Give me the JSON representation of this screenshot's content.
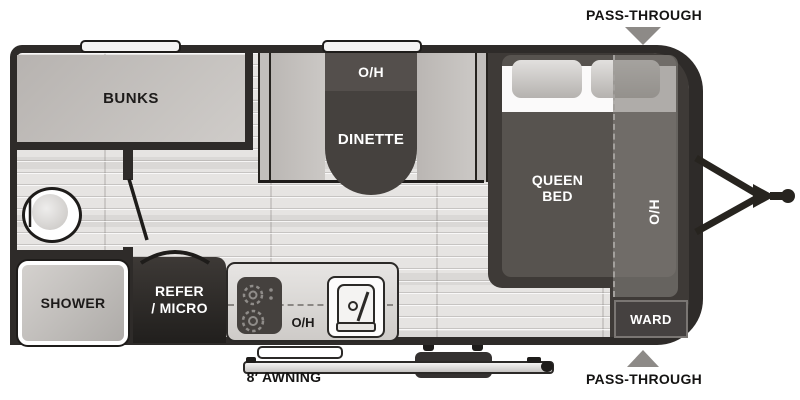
{
  "floorplan": {
    "exterior": {
      "pass_through_top": "PASS-THROUGH",
      "pass_through_bottom": "PASS-THROUGH",
      "awning": "8′ AWNING"
    },
    "rooms": {
      "bunks": "BUNKS",
      "dinette": {
        "overhead": "O/H",
        "name": "DINETTE"
      },
      "bedroom": {
        "bed_line1": "QUEEN",
        "bed_line2": "BED",
        "overhead": "O/H",
        "wardrobe": "WARD"
      },
      "bathroom": {
        "shower": "SHOWER"
      },
      "kitchen": {
        "refrigerator_line1": "REFER",
        "refrigerator_line2": "/ MICRO",
        "overhead": "O/H"
      }
    },
    "colors": {
      "wall": "#2e2b29",
      "floor": "#e6e4e2",
      "furniture_light": "#c6c3c0",
      "table_dark": "#45413e",
      "bed": "#57534f",
      "bed_overhead": "#807c78",
      "platform": "#3e3a37",
      "marker_gray": "#8d8a87"
    }
  }
}
